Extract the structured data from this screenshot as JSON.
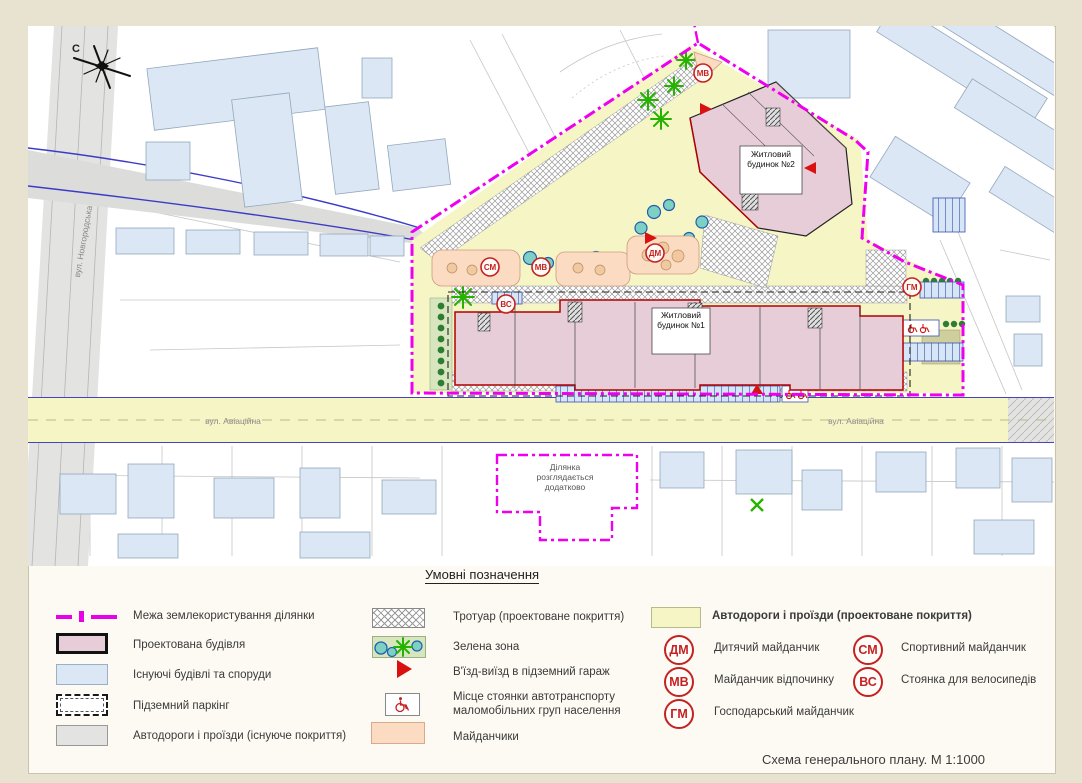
{
  "title_block": {
    "text": "Схема  генерального плану. М 1:1000"
  },
  "legend": {
    "heading": "Умовні позначення",
    "items_col1": [
      "Межа землекористування ділянки",
      "Проектована будівля",
      "Існуючі будівлі та споруди",
      "Підземний паркінг",
      "Автодороги і проїзди (існуюче покриття)"
    ],
    "items_col2": [
      "Тротуар (проектоване покриття)",
      "Зелена зона",
      "В'їзд-виїзд в підземний гараж",
      "Місце стоянки автотранспорту маломобільних груп населення",
      "Майданчики"
    ],
    "road_projected_label": "Автодороги і проїзди (проектоване покриття)",
    "badge_items_left": [
      {
        "code": "ДМ",
        "label": "Дитячий майданчик"
      },
      {
        "code": "МВ",
        "label": "Майданчик відпочинку"
      },
      {
        "code": "ГМ",
        "label": "Господарський майданчик"
      }
    ],
    "badge_items_right": [
      {
        "code": "СМ",
        "label": "Спортивний майданчик"
      },
      {
        "code": "ВС",
        "label": "Стоянка для велосипедів"
      }
    ]
  },
  "map": {
    "north_label": "С",
    "street_novhorodska": "вул. Новгородська",
    "street_aviatsiina": "вул. Авіаційна",
    "building1_label": "Житловий будинок №1",
    "building2_label": "Житловий будинок №2",
    "plot_note": "Ділянка розглядається додатково",
    "plan_badges": [
      "МВ",
      "СМ",
      "МВ",
      "ДМ",
      "ВС",
      "ГМ"
    ]
  },
  "colors": {
    "boundary": "#ee00ee",
    "projected_building": "#e7cdd8",
    "existing_building": "#dbe7f4",
    "road_existing": "#e0e0de",
    "road_projected": "#f6f5c6",
    "playground": "#fbdcc2",
    "green_zone": "#d8e6c0",
    "badge_red": "#c42222"
  }
}
